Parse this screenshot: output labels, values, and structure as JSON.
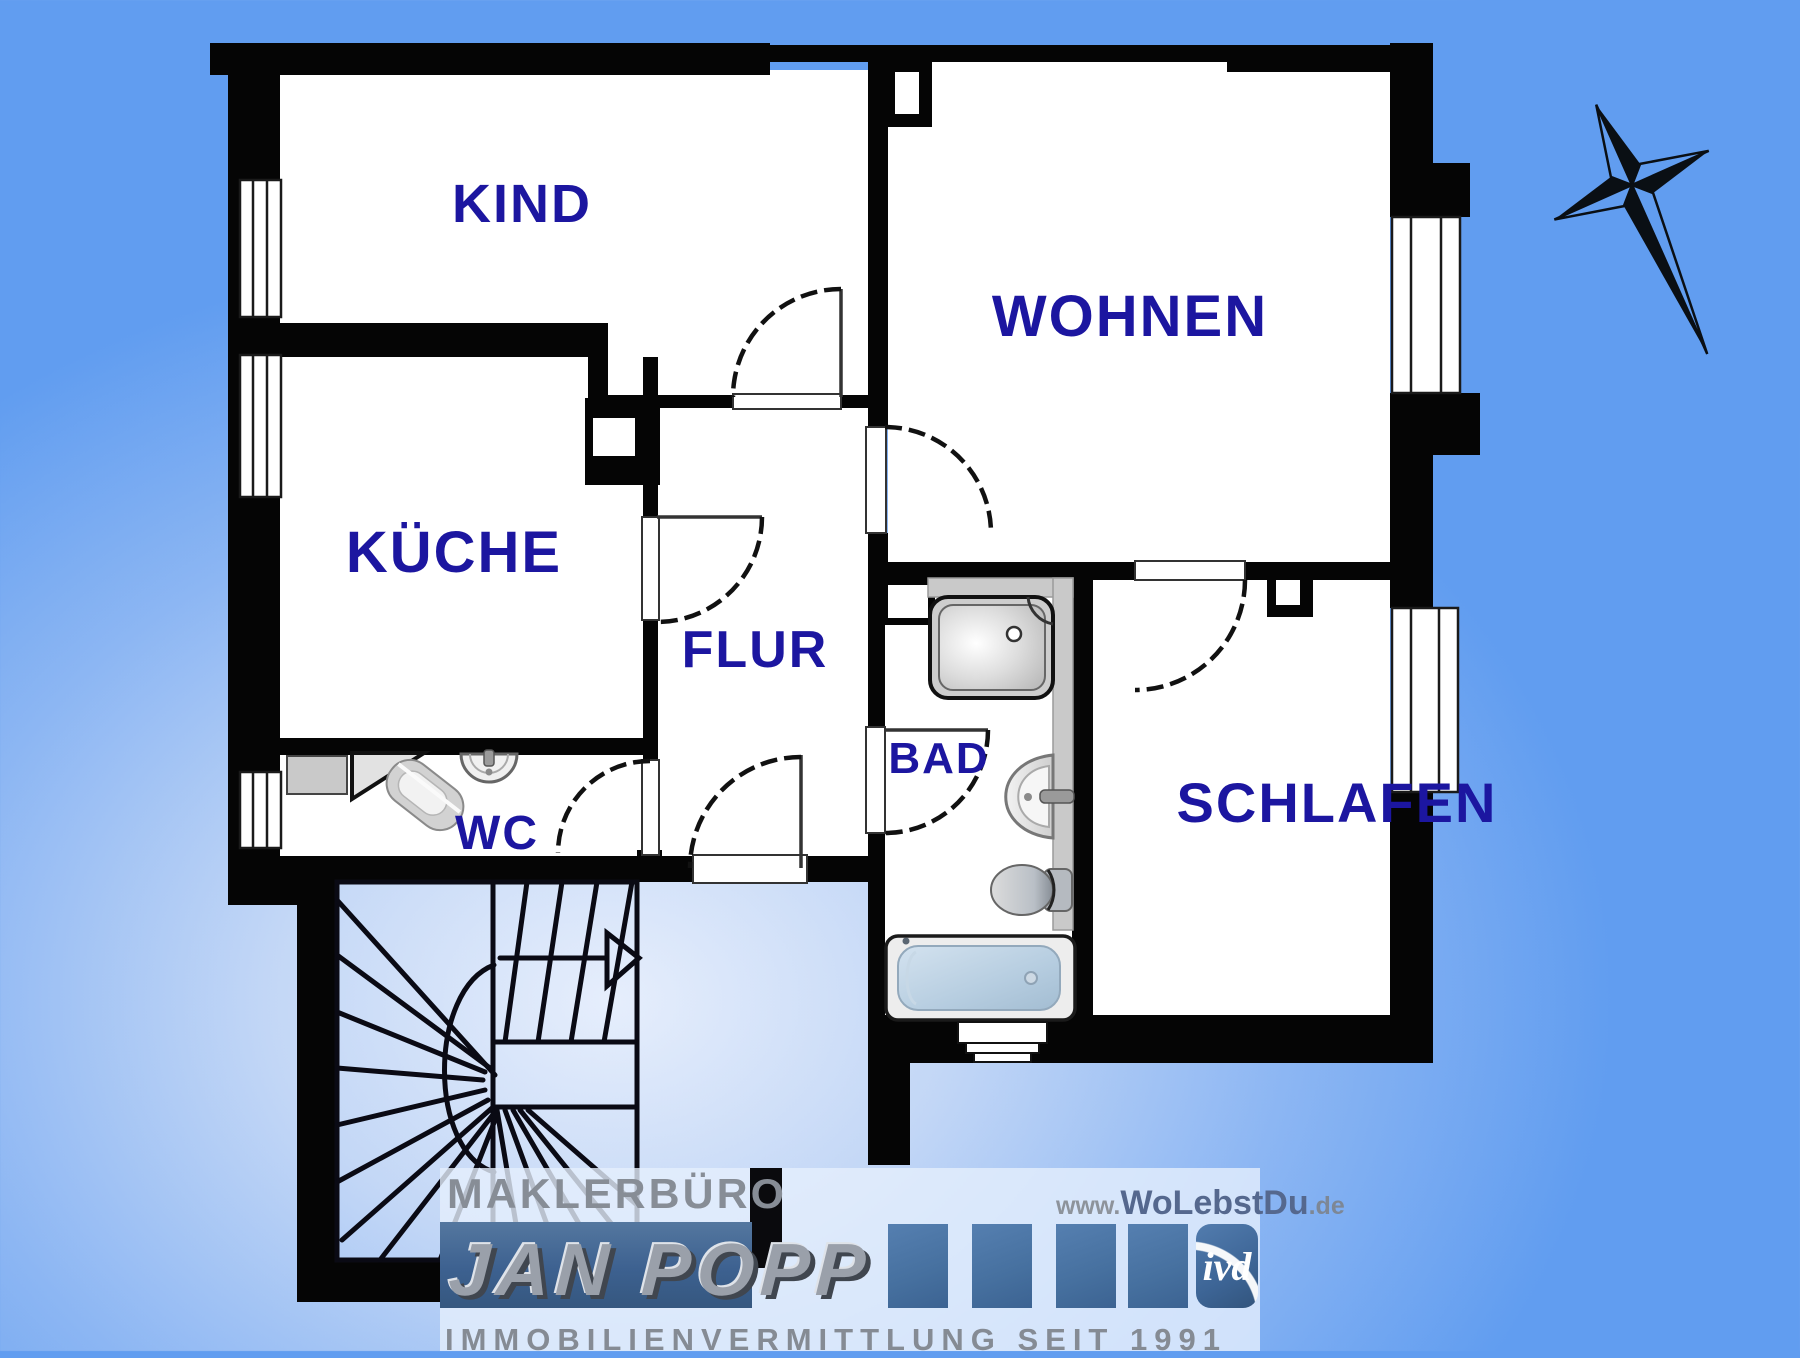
{
  "page": {
    "type": "apartment-floor-plan"
  },
  "colors": {
    "background_blue": "#619df0",
    "background_light_center": "#e6eefc",
    "wall_black": "#050505",
    "room_fill": "#ffffff",
    "label_navy": "#1c16a0",
    "fixture_gray": "#c9c9c9",
    "bathtub_blue": "#bdd3e6",
    "logo_band_blue": "#3d6190",
    "logo_square_blue": "#46709f",
    "logo_text_gray": "#878d96",
    "website_name_blue": "#55688e"
  },
  "rooms": [
    {
      "id": "kind",
      "label": "KIND"
    },
    {
      "id": "wohnen",
      "label": "WOHNEN"
    },
    {
      "id": "kueche",
      "label": "KÜCHE"
    },
    {
      "id": "flur",
      "label": "FLUR"
    },
    {
      "id": "bad",
      "label": "BAD"
    },
    {
      "id": "wc",
      "label": "WC"
    },
    {
      "id": "schlafen",
      "label": "SCHLAFEN"
    }
  ],
  "logo": {
    "office_line": "MAKLERBÜRO",
    "name_line": "JAN POPP",
    "website_prefix": "www.",
    "website_name": "WoLebstDu",
    "website_suffix": ".de",
    "tagline": "IMMOBILIENVERMITTLUNG SEIT 1991",
    "ivd_badge": "ivd"
  }
}
